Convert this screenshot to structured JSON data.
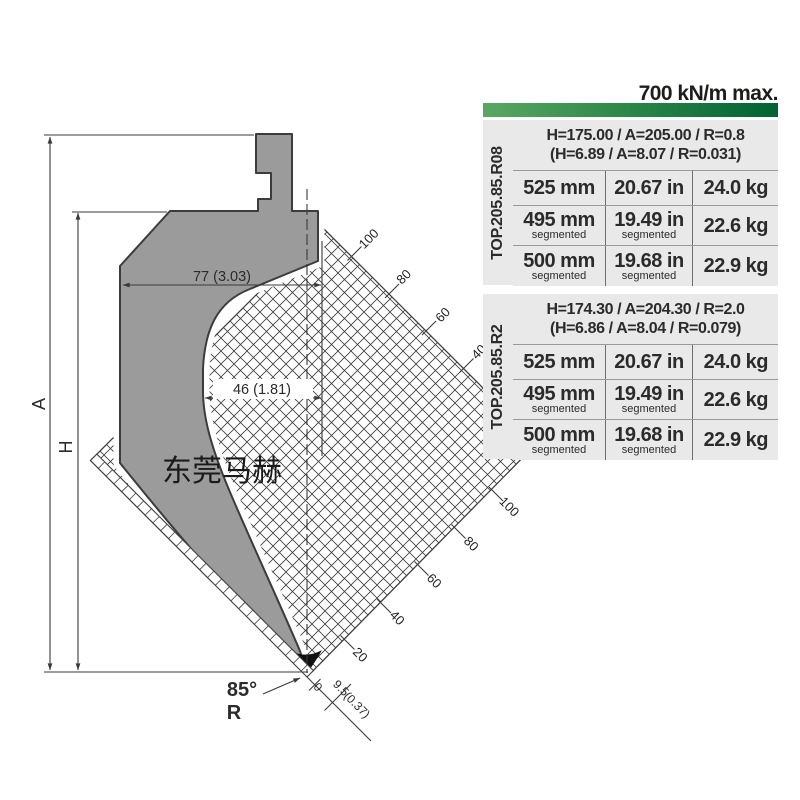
{
  "drawing": {
    "labels": {
      "a": "A",
      "h": "H",
      "width77": "77 (3.03)",
      "width46": "46 (1.81)",
      "angle": "85°",
      "r": "R",
      "tip0": "0",
      "tip95": "9.5",
      "tip037": "(0.37)",
      "watermark": "东莞马赫"
    },
    "ruler_top": [
      "100",
      "80",
      "60",
      "40"
    ],
    "ruler_bottom": [
      "100",
      "80",
      "60",
      "40",
      "20"
    ],
    "punch_gray": "#9b9b9b",
    "line_color": "#3a3a3a"
  },
  "table": {
    "capacity": "700 kN/m max.",
    "accent_green_dark": "#006233",
    "accent_green_light": "#5aa763",
    "sections": [
      {
        "model": "TOP.205.85.R08",
        "header_metric": "H=175.00 / A=205.00 / R=0.8",
        "header_imperial": "(H=6.89 / A=8.07 / R=0.031)",
        "rows": [
          {
            "mm": "525 mm",
            "mm_note": "",
            "in": "20.67 in",
            "in_note": "",
            "kg": "24.0 kg"
          },
          {
            "mm": "495 mm",
            "mm_note": "segmented",
            "in": "19.49 in",
            "in_note": "segmented",
            "kg": "22.6 kg"
          },
          {
            "mm": "500 mm",
            "mm_note": "segmented",
            "in": "19.68 in",
            "in_note": "segmented",
            "kg": "22.9 kg"
          }
        ]
      },
      {
        "model": "TOP.205.85.R2",
        "header_metric": "H=174.30 / A=204.30 / R=2.0",
        "header_imperial": "(H=6.86 / A=8.04 / R=0.079)",
        "rows": [
          {
            "mm": "525 mm",
            "mm_note": "",
            "in": "20.67 in",
            "in_note": "",
            "kg": "24.0 kg"
          },
          {
            "mm": "495 mm",
            "mm_note": "segmented",
            "in": "19.49 in",
            "in_note": "segmented",
            "kg": "22.6 kg"
          },
          {
            "mm": "500 mm",
            "mm_note": "segmented",
            "in": "19.68 in",
            "in_note": "segmented",
            "kg": "22.9 kg"
          }
        ]
      }
    ]
  }
}
